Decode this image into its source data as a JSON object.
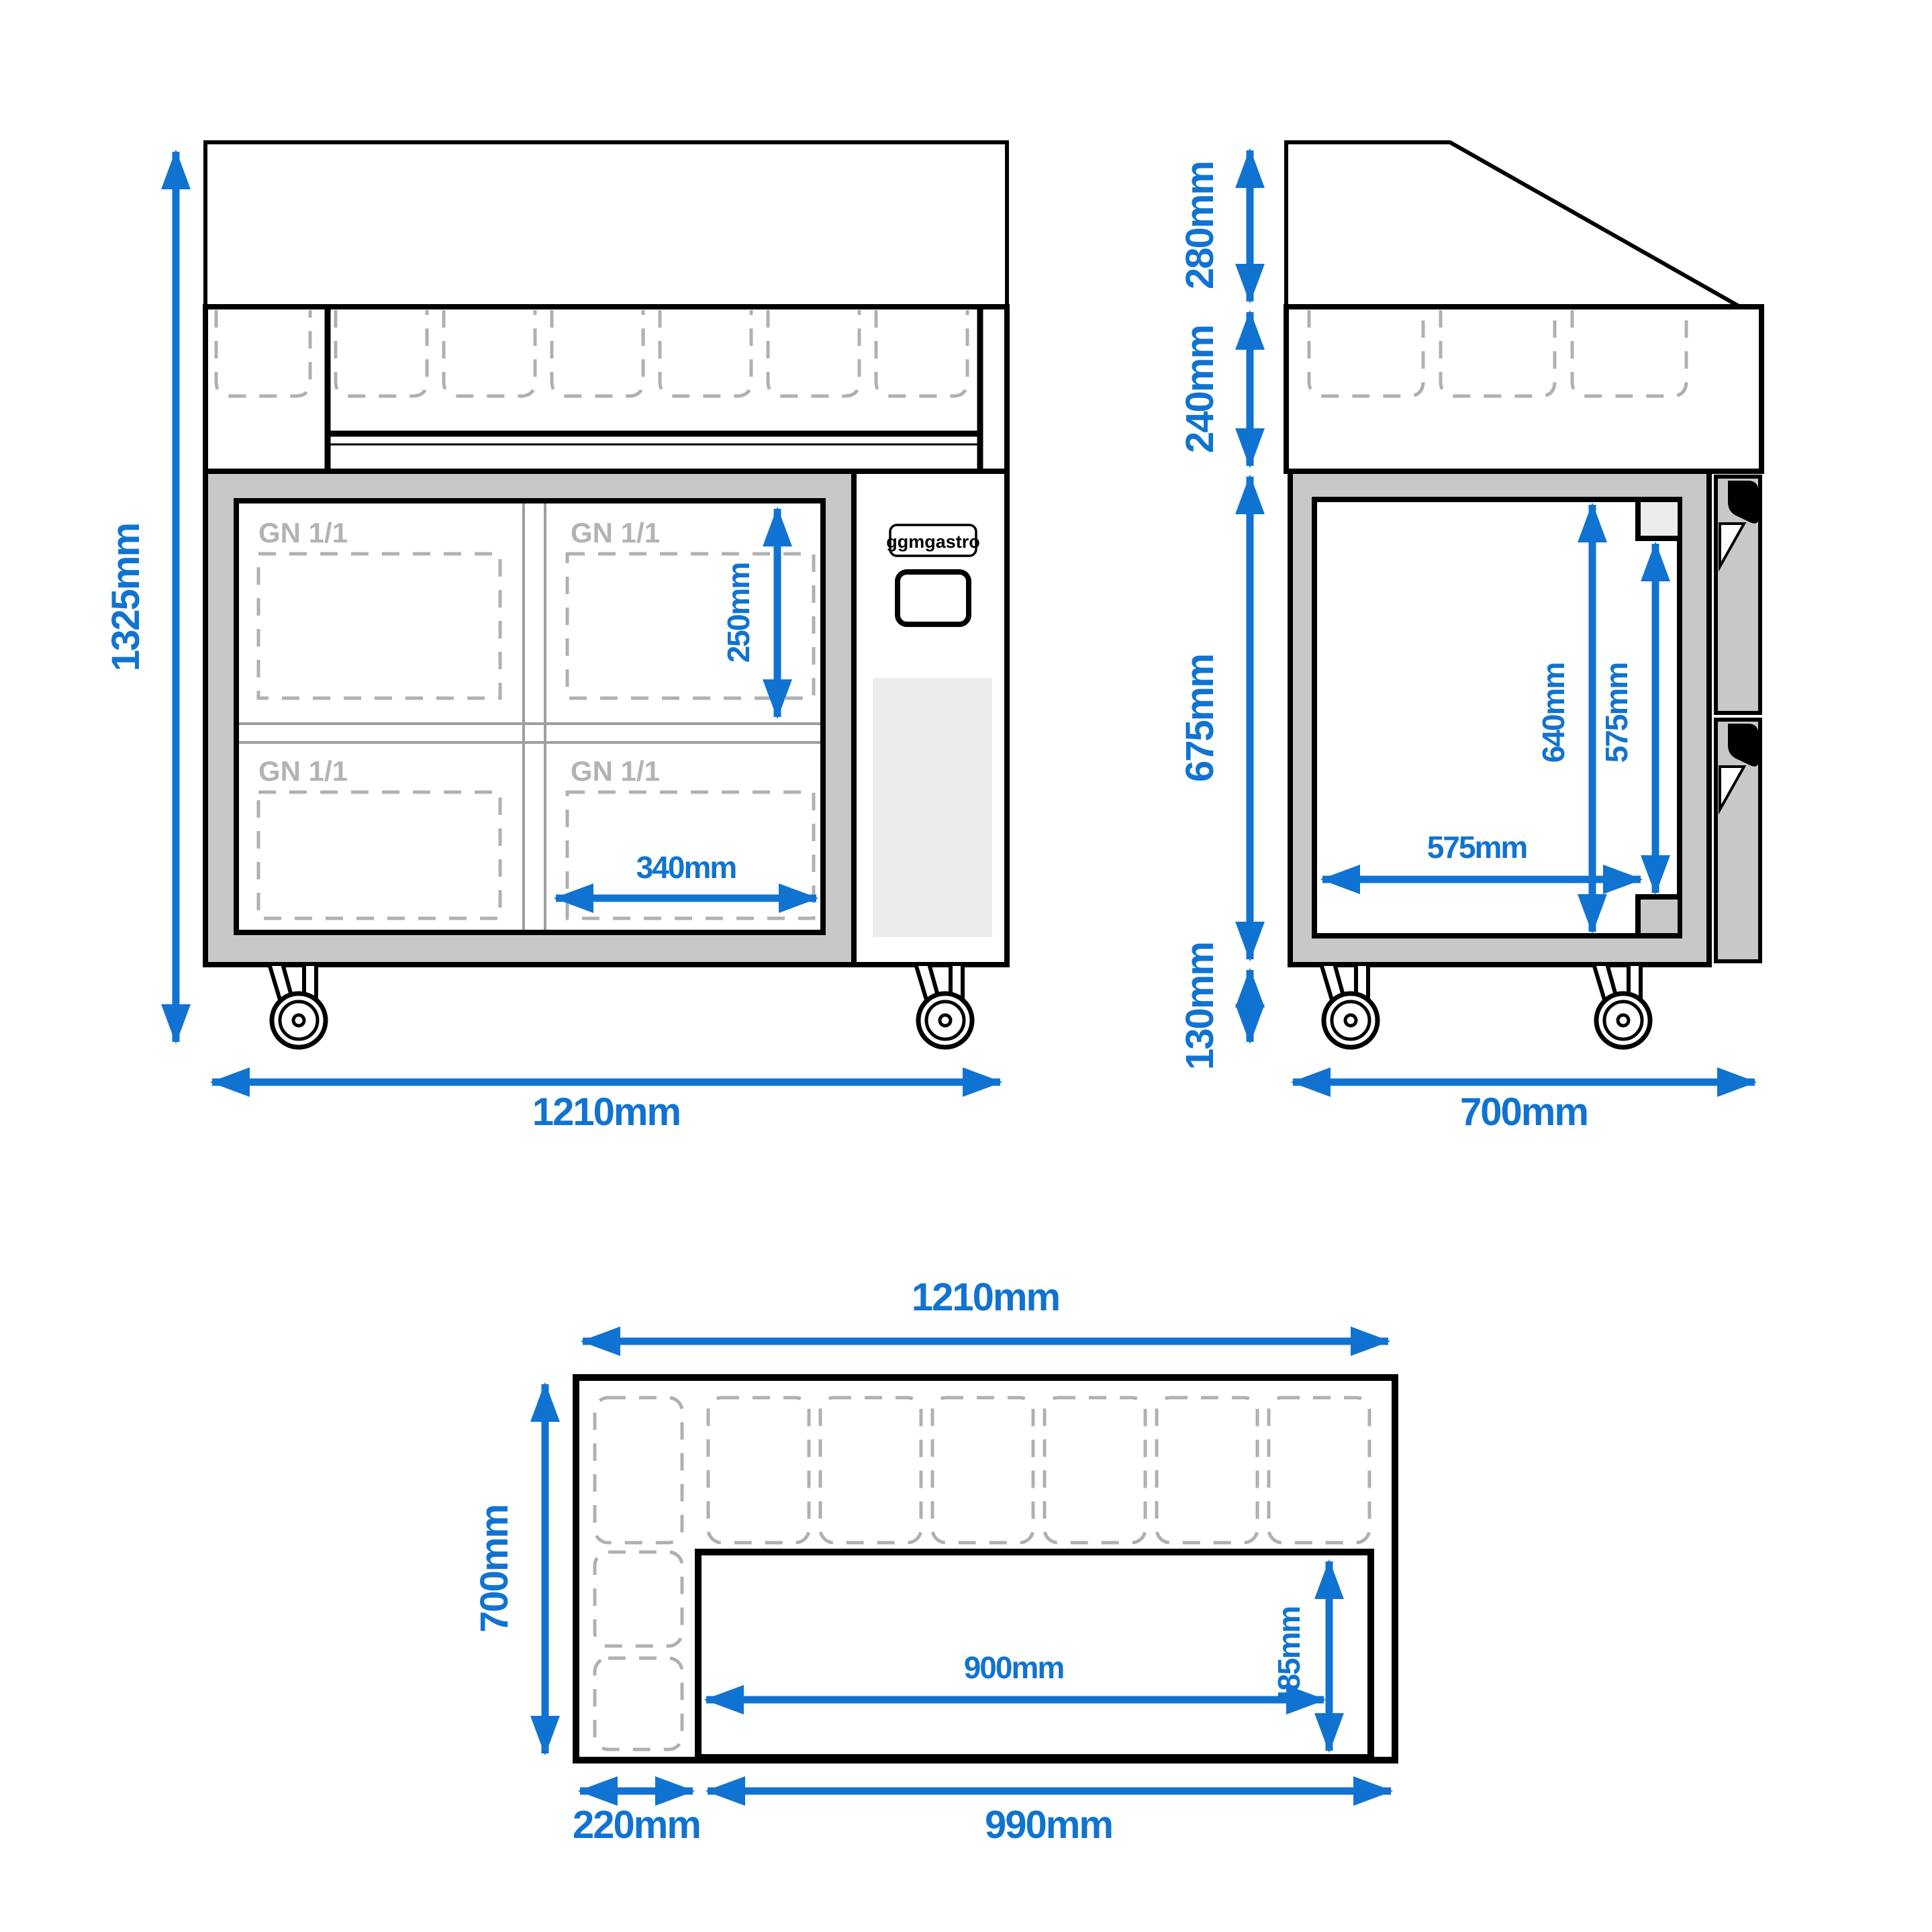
{
  "colors": {
    "dim_blue": "#1173d1",
    "frame_gray": "#c8c8c8",
    "vent_gray": "#ececec",
    "dash_gray": "#b0b0b0",
    "gn_text_gray": "#b3b3b3",
    "divider_gray": "#9e9e9e",
    "outline_black": "#000000"
  },
  "front_view": {
    "overall_height": "1325mm",
    "overall_width": "1210mm",
    "pan_depth": "250mm",
    "pan_width": "340mm",
    "gn_label": "GN 1/1",
    "brand": "ggmgastro"
  },
  "side_view": {
    "guard_height": "280mm",
    "rail_height": "240mm",
    "body_height": "675mm",
    "caster_height": "130mm",
    "overall_depth": "700mm",
    "interior_height": "640mm",
    "door_height": "575mm",
    "interior_depth": "575mm"
  },
  "top_view": {
    "overall_width": "1210mm",
    "overall_depth": "700mm",
    "left_section_width": "220mm",
    "worktop_width": "990mm",
    "cutout_width": "900mm",
    "cutout_depth": "485mm"
  }
}
